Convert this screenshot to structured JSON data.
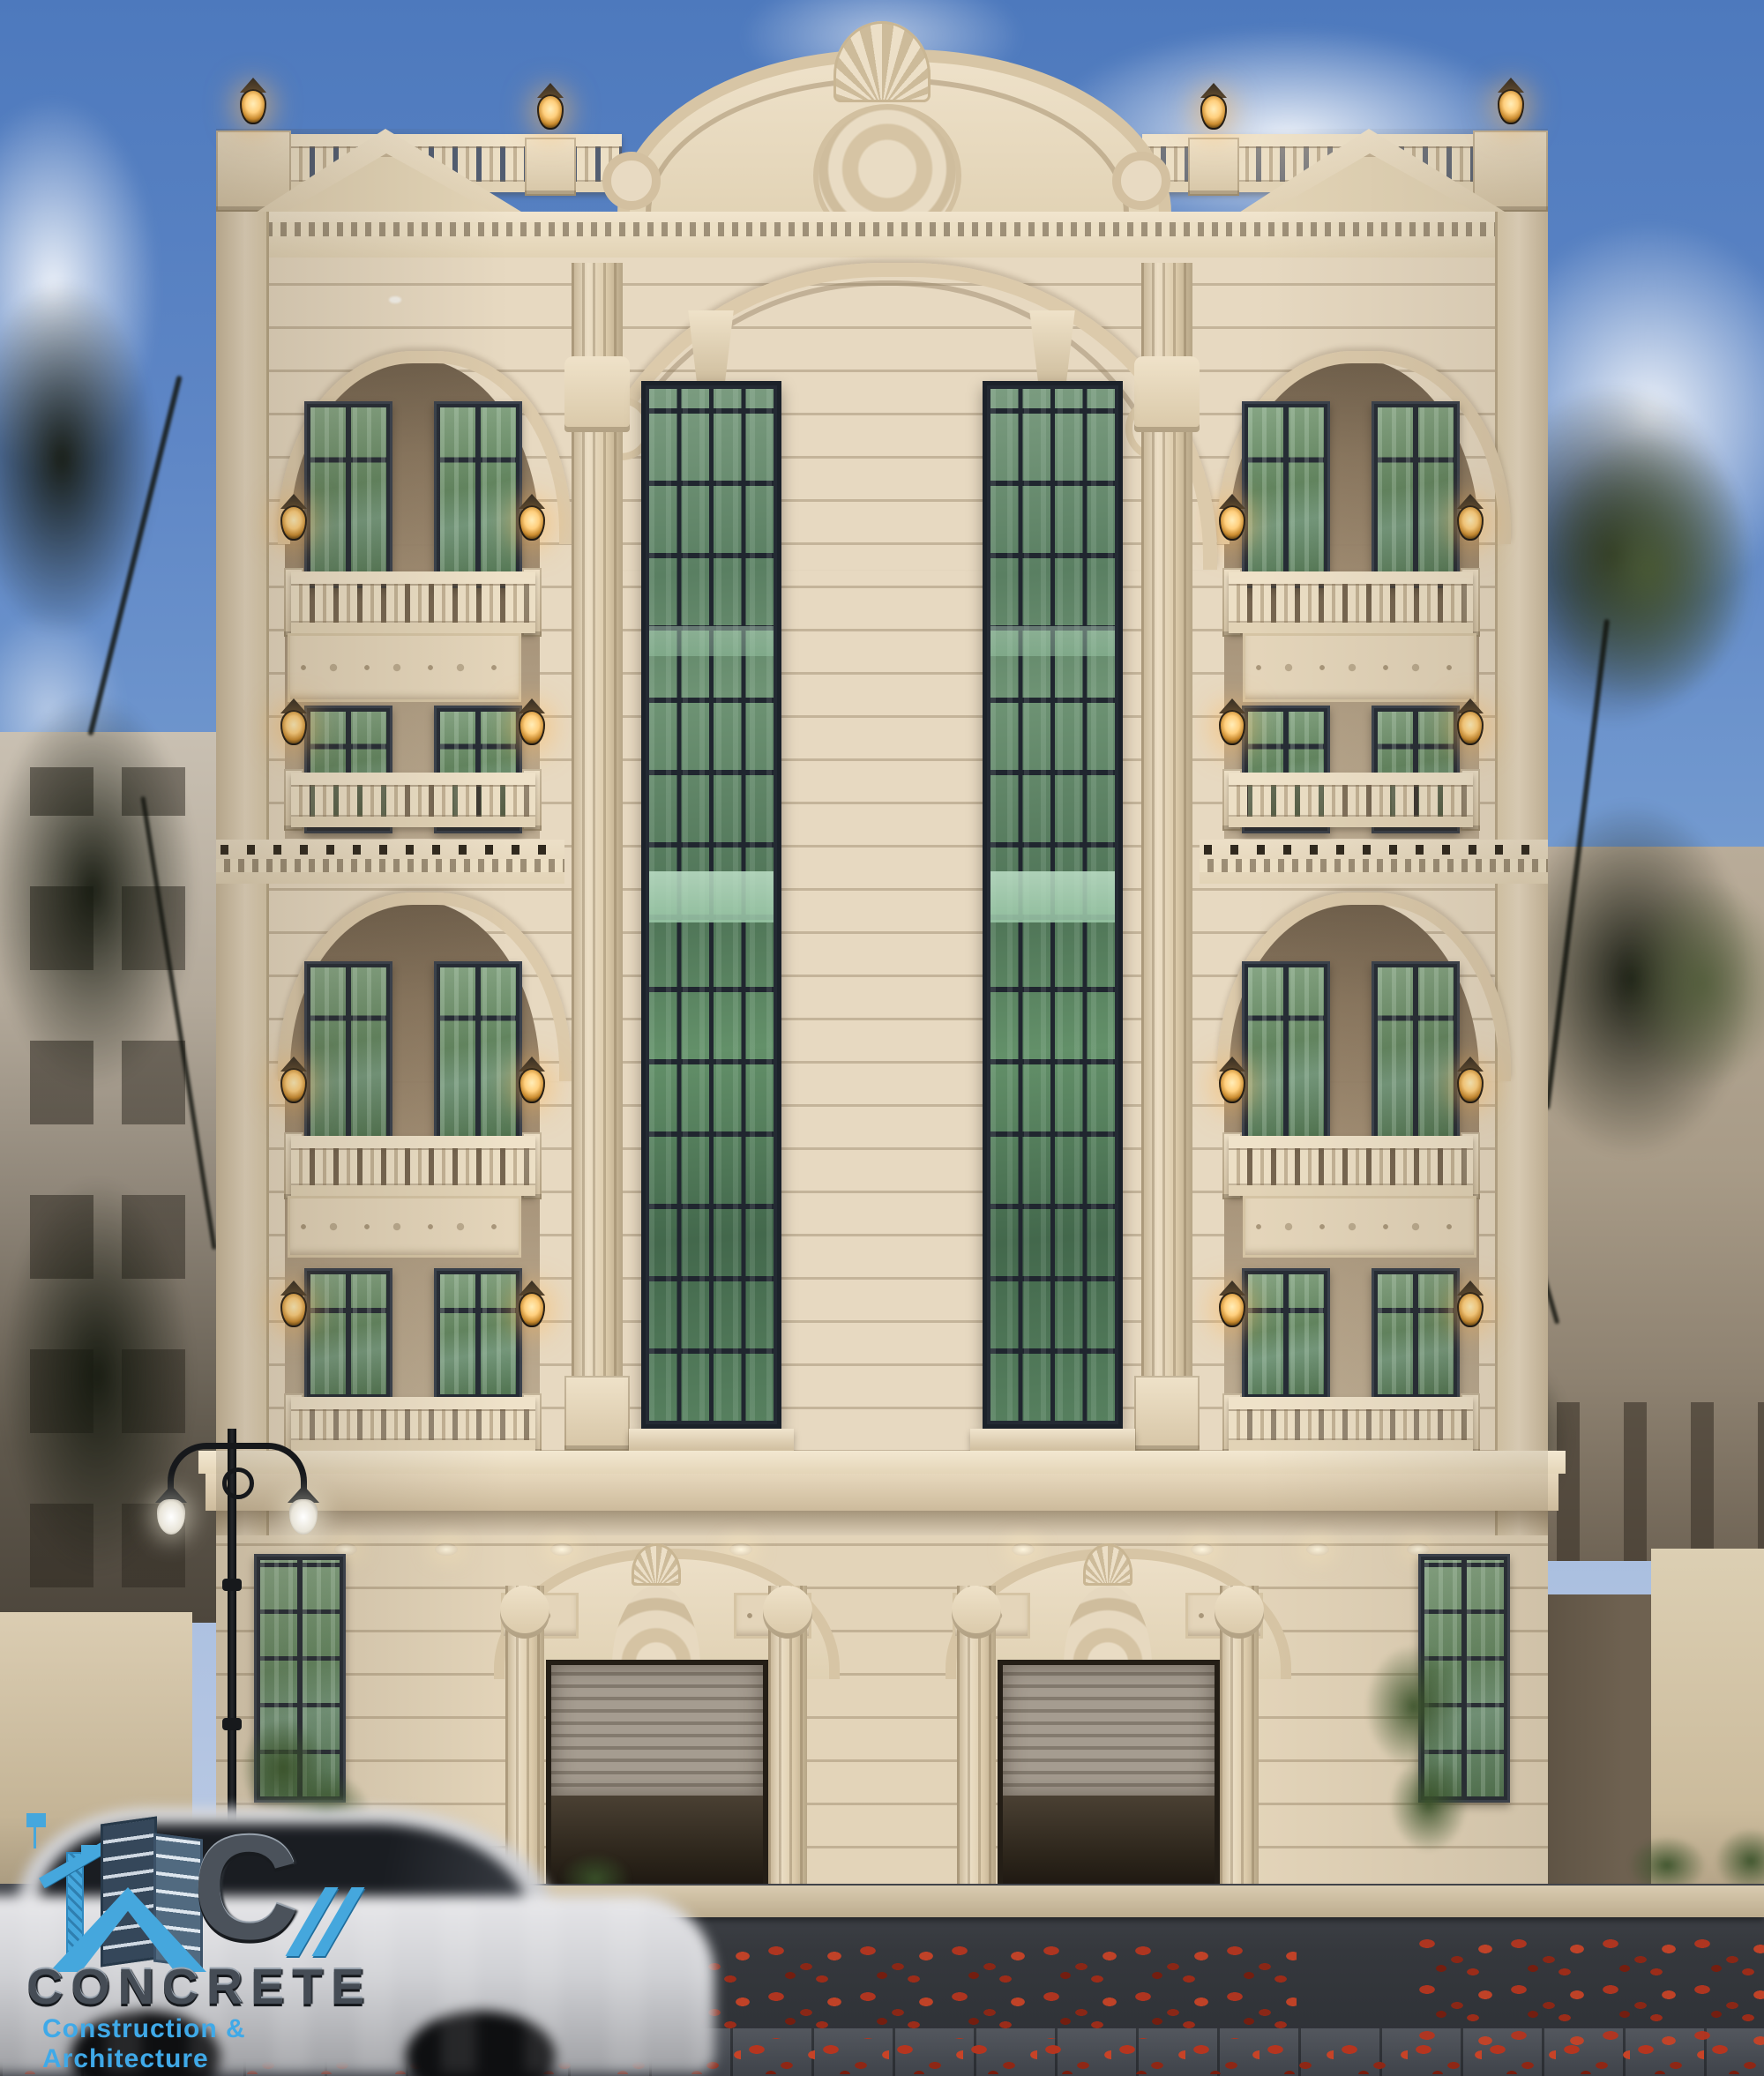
{
  "logo": {
    "monogram": "C",
    "slashes": "//",
    "name": "CONCRETE",
    "tagline": "Construction & Architecture"
  },
  "palette": {
    "sky_blue": "#5f87c6",
    "facade_cream": "#e8dac2",
    "loggia_shadow": "#8a775f",
    "glass_green": "#5a7f62",
    "glass_teal_band": "#aed8bb",
    "window_frame": "#262c35",
    "lantern_glow": "#ffcf7d",
    "cornice_light": "#f1e5ce",
    "roller_shutter": "#958c80",
    "road_asphalt": "#35383d",
    "fallen_leaf_red": "#b5351f",
    "logo_blue": "#45a7dd",
    "logo_gray": "#454c55"
  }
}
